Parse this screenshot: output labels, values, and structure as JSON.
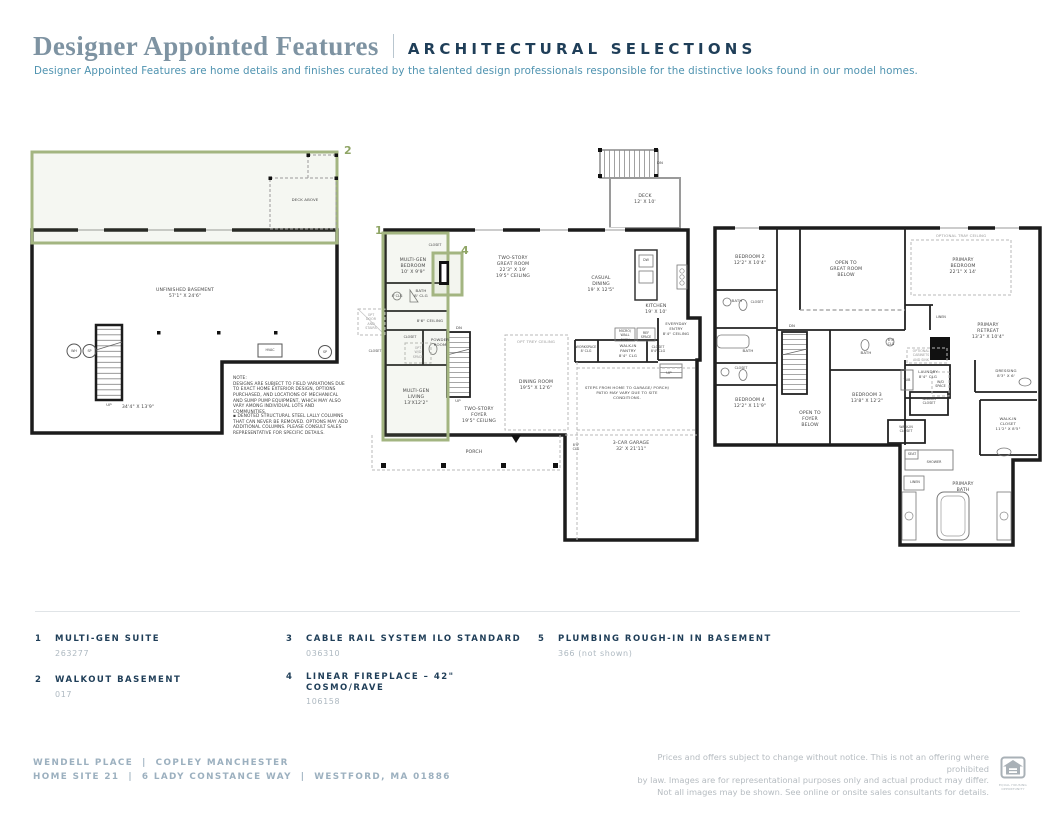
{
  "header": {
    "title": "Designer Appointed Features",
    "subtitle_caps": "ARCHITECTURAL SELECTIONS",
    "tagline": "Designer Appointed Features are home details and finishes curated by the talented design professionals responsible for the distinctive looks found in our model homes."
  },
  "plans": {
    "basement": {
      "marker": "2",
      "labels": {
        "deck_above": "DECK ABOVE",
        "room": "UNFINISHED BASEMENT\n57'1\" X 24'6\"",
        "up": "UP",
        "dim": "34'4\" X 13'9\"",
        "wh": "WH",
        "sp_left": "SP",
        "hvac": "HVAC",
        "sp_right": "SP",
        "note1": "NOTE:\nDESIGNS ARE SUBJECT TO FIELD VARIATIONS DUE\nTO EXACT HOME EXTERIOR DESIGN, OPTIONS\nPURCHASED, AND LOCATIONS OF MECHANICAL\nAND SUMP PUMP EQUIPMENT, WHICH MAY ALSO\nVARY AMONG INDIVIDUAL LOTS AND COMMUNITIES.",
        "note2": "▪ DENOTED STRUCTURAL STEEL LALLY COLUMNS\nTHAT CAN NEVER BE REMOVED. OPTIONS MAY ADD\nADDITIONAL COLUMNS. PLEASE CONSULT SALES\nREPRESENTATIVE FOR SPECIFIC DETAILS."
      }
    },
    "first_floor": {
      "marker_suite": "1",
      "marker_fireplace": "4",
      "labels": {
        "multigen_bedroom": "MULTI-GEN\nBEDROOM\n10' X 9'9\"",
        "closet_top": "CLOSET",
        "great_room": "TWO-STORY\nGREAT ROOM\n22'3\" X 19'\n19'5\" CEILING",
        "casual_dining": "CASUAL\nDINING\n19' X 12'5\"",
        "kitchen": "KITCHEN\n19' X 10'",
        "deck": "DECK\n12' X 10'",
        "dn_deck": "DN",
        "bath": "BATH\n8' CLG",
        "clg8": "8' CLG",
        "ceiling86": "8'6\" CEILING",
        "opt_door": "OPT\nDOOR\nAND\nSTAIRS",
        "closet_mid": "CLOSET",
        "powder": "POWDER\nROOM",
        "closet_left": "CLOSET",
        "opt_wd": "OPT\nW/D\nSPACE",
        "dn_stairs": "DN",
        "up_stairs": "UP",
        "multigen_living": "MULTI-GEN\nLIVING\n13'X12'2\"",
        "foyer": "TWO-STORY\nFOYER\n19'5\" CEILING",
        "dining": "DINING ROOM\n19'5\" X 12'6\"",
        "opt_trey": "OPT TREY CEILING",
        "workspace": "WORKSPACE\n8' CLG",
        "pantry": "WALK-IN\nPANTRY\n8'4\" CLG",
        "closet_entry": "CLOSET\n8'4\" CLG",
        "everyday": "EVERYDAY\nENTRY\n8'4\" CEILING",
        "wall_oven": "MICRO/\nWALL\nOVEN",
        "ref": "REF\nSPACE",
        "up_entry": "UP",
        "steps_note": "STEPS FROM HOME TO GARAGE/ PORCH/\nPATIO MAY VARY DUE TO SITE\nCONDITIONS.",
        "garage": "3-CAR GARAGE\n32' X 21'11\"",
        "garage_clg": "8'4\"\nCLG",
        "porch": "PORCH",
        "dw": "DW"
      }
    },
    "second_floor": {
      "labels": {
        "bedroom2": "BEDROOM 2\n12'2\" X 10'4\"",
        "open_great": "OPEN TO\nGREAT ROOM\nBELOW",
        "opt_tray": "OPTIONAL TRAY CEILING",
        "primary_bedroom": "PRIMARY\nBEDROOM\n22'1\" X 14'",
        "bath_upper": "BATH",
        "closet_upper": "CLOSET",
        "bath_mid": "BATH",
        "closet_mid": "CLOSET",
        "bedroom4": "BEDROOM 4\n12'2\" X 11'9\"",
        "open_foyer": "OPEN TO\nFOYER\nBELOW",
        "dn": "DN",
        "bath_right": "BATH",
        "bedroom3": "BEDROOM 3\n13'8\" X 12'2\"",
        "linen": "LINEN",
        "primary_retreat": "PRIMARY\nRETREAT\n13'3\" X 10'4\"",
        "clg84": "8'4\"\nCLG",
        "opt_cabinets": "OPTIONAL\nCABINETS\nAND SINK",
        "laundry": "LAUNDRY\n8'4\" CLG",
        "tub": "TUB",
        "wd_space": "W/D\nSPACE",
        "dressing": "DRESSING\n8'3\" X 6'",
        "wic_left": "WALK-IN\nCLOSET",
        "wic_small": "WALK-IN\nCLOSET",
        "wic_right": "WALK-IN\nCLOSET\n11'2\" X 8'5\"",
        "seat": "SEAT",
        "shower": "SHOWER",
        "linen2": "LINEN",
        "primary_bath": "PRIMARY\nBATH"
      }
    }
  },
  "legend": {
    "items": [
      {
        "num": "1",
        "title": "MULTI-GEN SUITE",
        "code": "263277"
      },
      {
        "num": "2",
        "title": "WALKOUT BASEMENT",
        "code": "017"
      },
      {
        "num": "3",
        "title": "CABLE RAIL SYSTEM ILO STANDARD",
        "code": "036310"
      },
      {
        "num": "4",
        "title": "LINEAR FIREPLACE – 42\"\nCOSMO/RAVE",
        "code": "106158"
      },
      {
        "num": "5",
        "title": "PLUMBING ROUGH-IN IN BASEMENT",
        "code": "366 (not shown)"
      }
    ]
  },
  "footer": {
    "community_line": "WENDELL PLACE  |  COPLEY MANCHESTER",
    "site_line": "HOME SITE 21  |  6 LADY CONSTANCE WAY  |  WESTFORD, MA 01886",
    "disclaimer": "Prices and offers subject to change without notice. This is not an offering where prohibited\nby law. Images are for representational purposes only and actual product may differ.\nNot all images may be shown. See online or onsite sales consultants for details.",
    "equal_housing_caption": "EQUAL HOUSING\nOPPORTUNITY"
  },
  "colors": {
    "accent_green": "#8fa565",
    "navy": "#1f3e58",
    "steel_blue": "#7e93a2",
    "teal": "#4f93b0",
    "muted_slate": "#9cb0bf",
    "light_gray": "#b6bcc1"
  }
}
